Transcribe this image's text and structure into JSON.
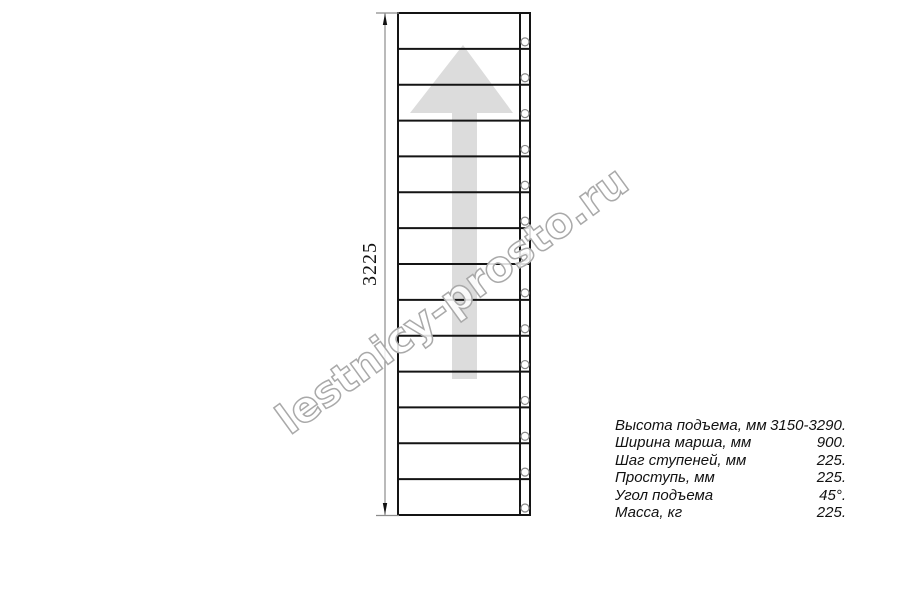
{
  "drawing": {
    "dimension_label": "3225",
    "steps_count": 14,
    "watermark_text": "lestnicy-prosto.ru",
    "colors": {
      "line": "#141414",
      "dimension": "#8c8c8c",
      "hole_stroke": "#878787",
      "arrow_fill": "#dcdcdc",
      "watermark_stroke": "#a9a9a9"
    }
  },
  "specs": {
    "rows": [
      {
        "label": "Высота подъема, мм",
        "value": "3150-3290."
      },
      {
        "label": "Ширина марша, мм",
        "value": "900."
      },
      {
        "label": "Шаг ступеней, мм",
        "value": "225."
      },
      {
        "label": "Проступь, мм",
        "value": "225."
      },
      {
        "label": "Угол подъема",
        "value": "45°."
      },
      {
        "label": "Масса, кг",
        "value": "225."
      }
    ]
  }
}
